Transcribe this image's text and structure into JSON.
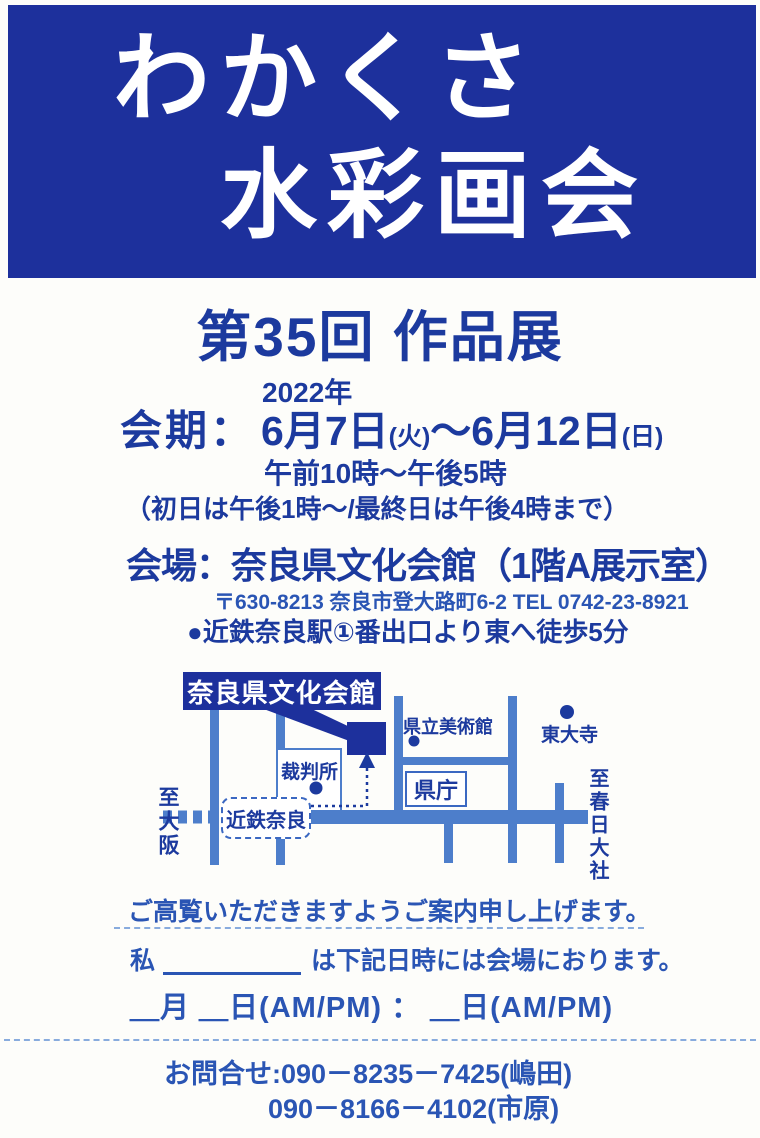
{
  "colors": {
    "banner-blue": "#1d309c",
    "ink-navy": "#1c3a9e",
    "ink-medium": "#2a55b4",
    "road-blue": "#4d7ecb",
    "paper": "#fdfdfa"
  },
  "banner": {
    "line1": "わかくさ",
    "line2": "水彩画会"
  },
  "title": "第35回 作品展",
  "schedule": {
    "year": "2022年",
    "label": "会期：",
    "date_start": "6月7日",
    "weekday_start": "(火)",
    "tilde": "～",
    "date_end": "6月12日",
    "weekday_end": "(日)",
    "hours": "午前10時～午後5時",
    "note": "（初日は午後1時～/最終日は午後4時まで）"
  },
  "venue": {
    "line": "会場：奈良県文化会館（1階A展示室）",
    "address": "〒630-8213 奈良市登大路町6-2 TEL 0742-23-8921",
    "access": "●近鉄奈良駅①番出口より東へ徒歩5分"
  },
  "map": {
    "venue_label": "奈良県文化会館",
    "courthouse": "裁判所",
    "museum": "県立美術館",
    "todaiji": "東大寺",
    "pref_office": "県庁",
    "station": "近鉄奈良",
    "to_osaka": "至大阪",
    "to_kasuga_taisha": "至春日大社"
  },
  "greeting": "ご高覧いただきますようご案内申し上げます。",
  "form": {
    "prefix": "私",
    "suffix": "は下記日時には会場におります。",
    "datetime_line": "＿月 ＿日(AM/PM) ： ＿日(AM/PM)"
  },
  "contact": {
    "label": "お問合せ:",
    "phone1": "090－8235－7425(嶋田)",
    "phone2": "090－8166－4102(市原)"
  }
}
